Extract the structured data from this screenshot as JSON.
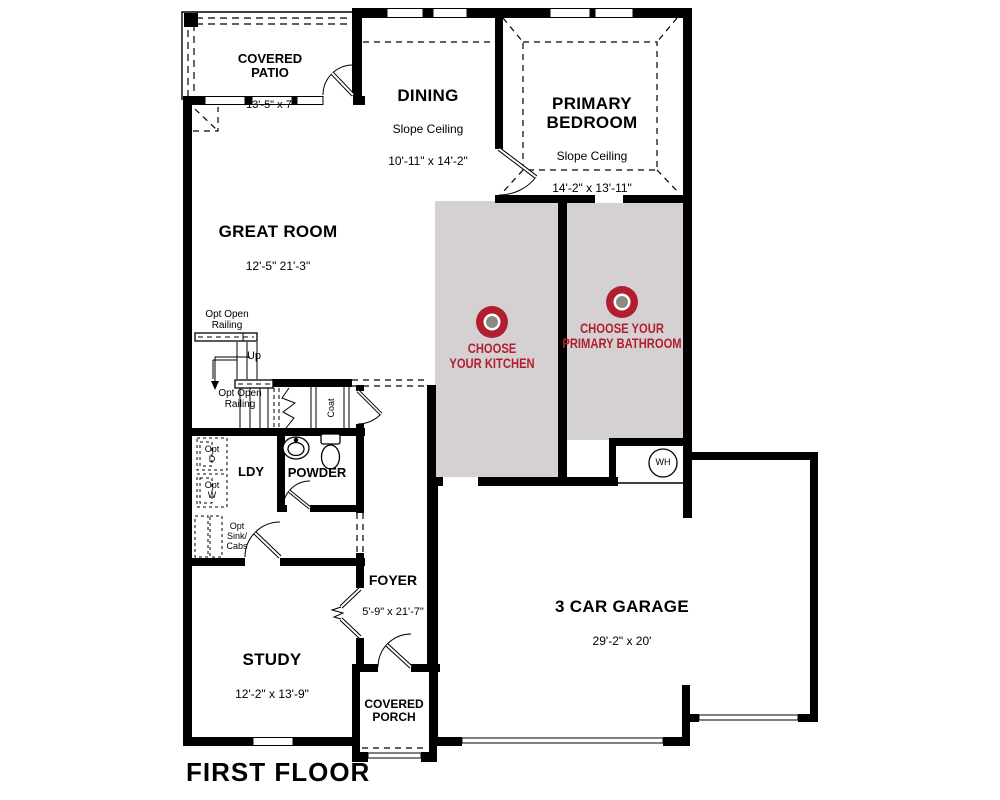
{
  "plan_title": "FIRST FLOOR",
  "rooms": {
    "covered_patio": {
      "name": "COVERED\nPATIO",
      "dims": "13'-5\" x 7'"
    },
    "dining": {
      "name": "DINING",
      "ceiling": "Slope Ceiling",
      "dims": "10'-11\" x 14'-2\""
    },
    "primary_bedroom": {
      "name": "PRIMARY\nBEDROOM",
      "ceiling": "Slope Ceiling",
      "dims": "14'-2\" x 13'-11\""
    },
    "great_room": {
      "name": "GREAT ROOM",
      "dims": "12'-5\"  21'-3\""
    },
    "laundry": {
      "name": "LDY"
    },
    "powder": {
      "name": "POWDER"
    },
    "foyer": {
      "name": "FOYER",
      "dims": "5'-9\" x 21'-7\""
    },
    "study": {
      "name": "STUDY",
      "dims": "12'-2\" x 13'-9\""
    },
    "garage": {
      "name": "3 CAR GARAGE",
      "dims": "29'-2\" x 20'"
    },
    "covered_porch": {
      "name": "COVERED\nPORCH"
    }
  },
  "option_zones": {
    "kitchen": {
      "label": "CHOOSE\nYOUR KITCHEN"
    },
    "primary_bathroom": {
      "label": "CHOOSE YOUR\nPRIMARY BATHROOM"
    }
  },
  "annotations": {
    "opt_open_railing": "Opt Open\nRailing",
    "up": "Up",
    "coat": "Coat",
    "opt_dryer": "Opt\nD",
    "opt_washer": "Opt\nW",
    "opt_sink_cabs": "Opt\nSink/\nCabs",
    "water_heater": "WH"
  },
  "colors": {
    "wall": "#000000",
    "background": "#ffffff",
    "option_zone_bg": "#d5d1d2",
    "accent_red": "#b01e30",
    "icon_center": "#8a8a83"
  }
}
